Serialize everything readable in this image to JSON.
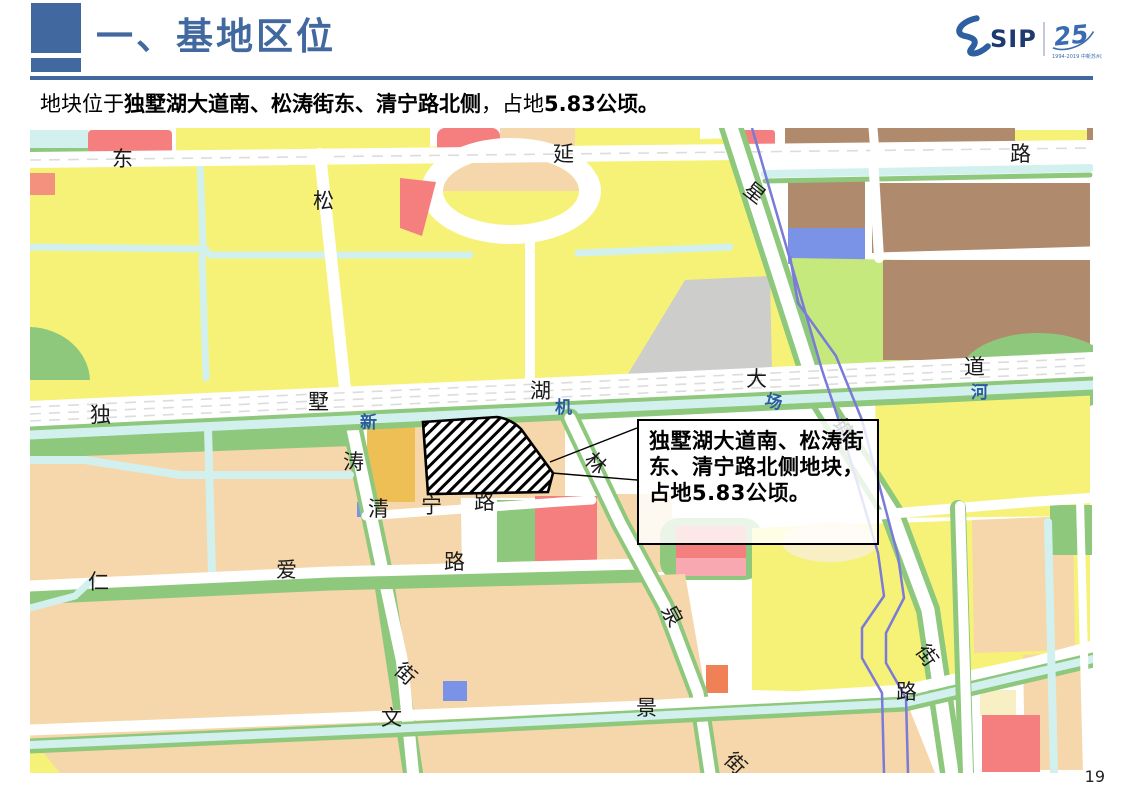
{
  "slide": {
    "title": "一、基地区位",
    "subtitle_prefix": "地块位于",
    "subtitle_bold": "独墅湖大道南、松涛街东、清宁路北侧",
    "subtitle_mid": "，占地",
    "subtitle_area": "5.83",
    "subtitle_suffix": "公顷。",
    "page_number": "19"
  },
  "logo": {
    "s_mark": "S",
    "sip_text": "SIP",
    "anniversary": "25",
    "small_text": "1994-2019 中新苏州工业园区"
  },
  "callout": {
    "text": "独墅湖大道南、松涛街东、清宁路北侧地块，占地5.83公顷。"
  },
  "map": {
    "labels": [
      {
        "t": "东",
        "x": 82,
        "y": 38
      },
      {
        "t": "延",
        "x": 523,
        "y": 33
      },
      {
        "t": "路",
        "x": 980,
        "y": 33
      },
      {
        "t": "松",
        "x": 283,
        "y": 80
      },
      {
        "t": "星",
        "x": 712,
        "y": 64,
        "r": 38
      },
      {
        "t": "独",
        "x": 60,
        "y": 294
      },
      {
        "t": "墅",
        "x": 278,
        "y": 281
      },
      {
        "t": "湖",
        "x": 500,
        "y": 270
      },
      {
        "t": "大",
        "x": 716,
        "y": 258
      },
      {
        "t": "道",
        "x": 934,
        "y": 246
      },
      {
        "t": "新",
        "x": 330,
        "y": 300,
        "c": "blue",
        "s": 17
      },
      {
        "t": "机",
        "x": 525,
        "y": 285,
        "c": "blue",
        "s": 17
      },
      {
        "t": "场",
        "x": 734,
        "y": 277,
        "c": "blue",
        "s": 17,
        "r": 15
      },
      {
        "t": "河",
        "x": 941,
        "y": 270,
        "c": "blue",
        "s": 17
      },
      {
        "t": "涛",
        "x": 313,
        "y": 341
      },
      {
        "t": "塘",
        "x": 801,
        "y": 297,
        "r": 55
      },
      {
        "t": "清",
        "x": 338,
        "y": 388
      },
      {
        "t": "宁",
        "x": 391,
        "y": 385
      },
      {
        "t": "路",
        "x": 444,
        "y": 381
      },
      {
        "t": "林",
        "x": 553,
        "y": 333,
        "r": 45
      },
      {
        "t": "仁",
        "x": 58,
        "y": 461
      },
      {
        "t": "爱",
        "x": 246,
        "y": 449
      },
      {
        "t": "路",
        "x": 414,
        "y": 441
      },
      {
        "t": "泉",
        "x": 631,
        "y": 482,
        "r": 62
      },
      {
        "t": "街",
        "x": 363,
        "y": 544,
        "r": 42
      },
      {
        "t": "文",
        "x": 351,
        "y": 597
      },
      {
        "t": "景",
        "x": 606,
        "y": 587
      },
      {
        "t": "街",
        "x": 693,
        "y": 633,
        "r": 45
      },
      {
        "t": "街",
        "x": 885,
        "y": 523,
        "r": 55
      },
      {
        "t": "路",
        "x": 866,
        "y": 571
      }
    ]
  },
  "palette": {
    "yellow": "#F6F277",
    "peach": "#F5D7AB",
    "green": "#8EC87D",
    "light_green": "#C6E97D",
    "cyan": "#D2F1EE",
    "brown": "#B08A6C",
    "red": "#F57F7F",
    "blue_block": "#7B93E6",
    "gray": "#CDCDCC",
    "orange": "#EDBF54",
    "purple": "#7A7AD9",
    "title_blue": "#41689F",
    "label_blue": "#2C5C9E",
    "logo_blue": "#2E5FA0",
    "logo_dark": "#1E3A6E"
  }
}
